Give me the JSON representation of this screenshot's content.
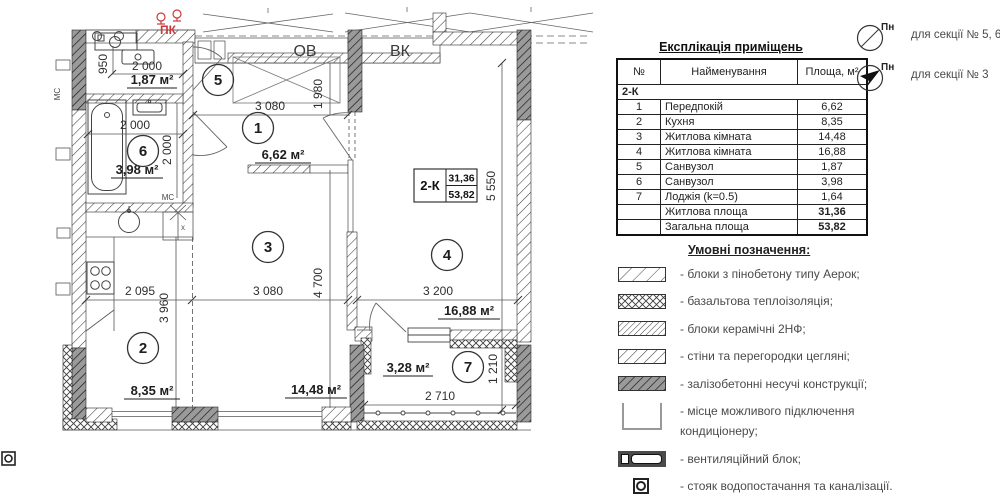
{
  "plan": {
    "labels": {
      "ov": "ОВ",
      "vk": "ВК",
      "pk": "ПК",
      "ms": "МС",
      "x_mark": "х"
    },
    "dims": {
      "d950": "950",
      "d2000": "2 000",
      "d1980": "1 980",
      "d3080": "3 080",
      "d5550": "5 550",
      "d2095": "2 095",
      "d3960": "3 960",
      "d4700": "4 700",
      "d3200": "3 200",
      "d2710": "2 710",
      "d1210": "1 210"
    },
    "rooms": [
      {
        "num": "1",
        "area": "6,62 м²"
      },
      {
        "num": "2",
        "area": "8,35 м²"
      },
      {
        "num": "3",
        "area": "14,48 м²"
      },
      {
        "num": "4",
        "area": "16,88 м²"
      },
      {
        "num": "5",
        "area": "1,87 м²"
      },
      {
        "num": "6",
        "area": "3,98 м²"
      },
      {
        "num": "7",
        "area": "3,28 м²"
      }
    ],
    "tag": {
      "type": "2-К",
      "living": "31,36",
      "total": "53,82"
    }
  },
  "table": {
    "title": "Експлікація приміщень",
    "headers": {
      "num": "№",
      "name": "Найменування",
      "area": "Площа, м²"
    },
    "group": "2-К",
    "rows": [
      {
        "num": "1",
        "name": "Передпокій",
        "area": "6,62"
      },
      {
        "num": "2",
        "name": "Кухня",
        "area": "8,35"
      },
      {
        "num": "3",
        "name": "Житлова кімната",
        "area": "14,48"
      },
      {
        "num": "4",
        "name": "Житлова кімната",
        "area": "16,88"
      },
      {
        "num": "5",
        "name": "Санвузол",
        "area": "1,87"
      },
      {
        "num": "6",
        "name": "Санвузол",
        "area": "3,98"
      },
      {
        "num": "7",
        "name": "Лоджія (k=0.5)",
        "area": "1,64"
      }
    ],
    "totals": [
      {
        "name": "Житлова площа",
        "area": "31,36"
      },
      {
        "name": "Загальна площа",
        "area": "53,82"
      }
    ]
  },
  "compasses": [
    {
      "label": "Пн",
      "caption": "для секції № 5, 6"
    },
    {
      "label": "Пн",
      "caption": "для секції № 3"
    }
  ],
  "legend": {
    "title": "Умовні позначення:",
    "items": [
      {
        "text": "- блоки з пінобетону типу Аерок;"
      },
      {
        "text": "- базальтова теплоізоляція;"
      },
      {
        "text": "- блоки керамічні 2НФ;"
      },
      {
        "text": "- стіни та перегородки цегляні;"
      },
      {
        "text": "- залізобетонні несучі конструкції;"
      },
      {
        "text": "- місце можливого підключення",
        "text2": "кондиціонеру;"
      },
      {
        "text": "- вентиляційний блок;"
      },
      {
        "text": "- стояк водопостачання та каналізації."
      }
    ]
  },
  "colors": {
    "accent_red": "#c9393b",
    "line": "#2b2b2b",
    "dark_wall": "#9a9a9a"
  }
}
